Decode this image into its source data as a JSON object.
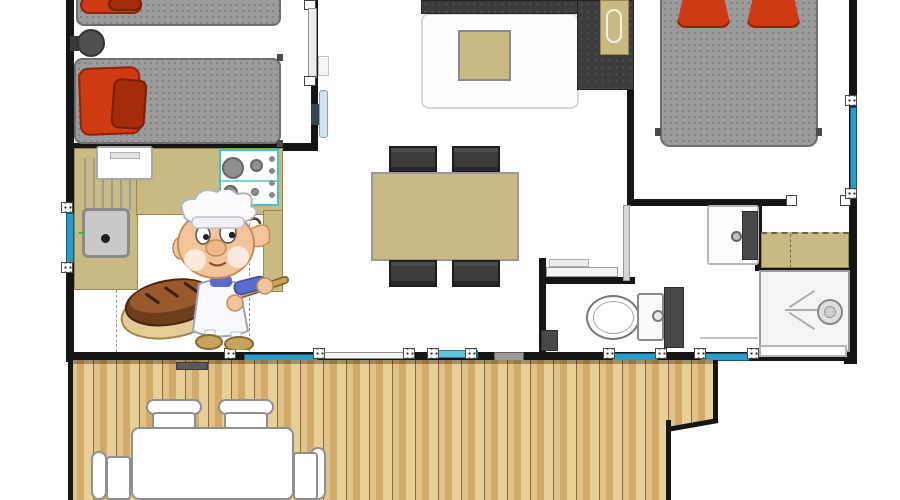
{
  "meta": {
    "type": "floor-plan",
    "title": ""
  },
  "colors": {
    "wall": "#151515",
    "floor": "#ffffff",
    "mattress": "#9b9b9b",
    "mattress_border": "#6f6f6f",
    "pillow_red": "#ce3b12",
    "pillow_dark_red": "#a52b0a",
    "sofa": "#3c3c3e",
    "tan": "#c9ba83",
    "tan_border": "#97894f",
    "rug": "#fdfdfd",
    "rug_border": "#d8d8d8",
    "window_blue": "#2a9cc7",
    "window_blue_light": "#63c2dc",
    "window_navy": "#17526f",
    "frame_white": "#f1f1f1",
    "hob_teal": "#3fc6c9",
    "burner_gray": "#8f8f8f",
    "steel": "#bdbdbd",
    "dark_fixture": "#48484b",
    "white_furniture": "#ffffff",
    "furniture_border": "#909090",
    "deck_light": "#e0c28a",
    "deck_light2": "#e7cf97",
    "deck_mid": "#d2ab68",
    "deck_line": "#8a6b39",
    "skin": "#f2c49c",
    "skin_shade": "#c68a58",
    "bread_dark": "#6e3e1b",
    "bread_light": "#985a2b",
    "paddle": "#e3cc96",
    "handle_wood": "#b68d4e",
    "sleeve_blue": "#5b6cc8",
    "hat_white": "#fbfbfd",
    "green_accent": "#3cb44a"
  },
  "rooms": [
    {
      "name": "bedroom-twin",
      "items": [
        "single-bed",
        "single-bed",
        "red-pillows",
        "bedside-stool",
        "sliding-door"
      ]
    },
    {
      "name": "kitchen",
      "items": [
        "l-counter",
        "sink",
        "drainer",
        "gas-hob",
        "appliance"
      ]
    },
    {
      "name": "living-dining",
      "items": [
        "corner-sofa",
        "coffee-table",
        "rug",
        "dining-table",
        "four-chairs",
        "hinged-door"
      ]
    },
    {
      "name": "bedroom-double",
      "items": [
        "double-bed",
        "red-pillows",
        "window"
      ]
    },
    {
      "name": "bathroom",
      "items": [
        "washbasin",
        "vanity-counter",
        "shower"
      ]
    },
    {
      "name": "wc",
      "items": [
        "toilet",
        "cistern",
        "sliding-door",
        "window"
      ]
    },
    {
      "name": "terrace",
      "items": [
        "wood-deck",
        "outdoor-table",
        "four-outdoor-chairs"
      ]
    }
  ],
  "mascot": {
    "name": "baker-elf-mascot",
    "items": [
      "chef-hat",
      "bread-loaf",
      "baker-peel"
    ]
  }
}
